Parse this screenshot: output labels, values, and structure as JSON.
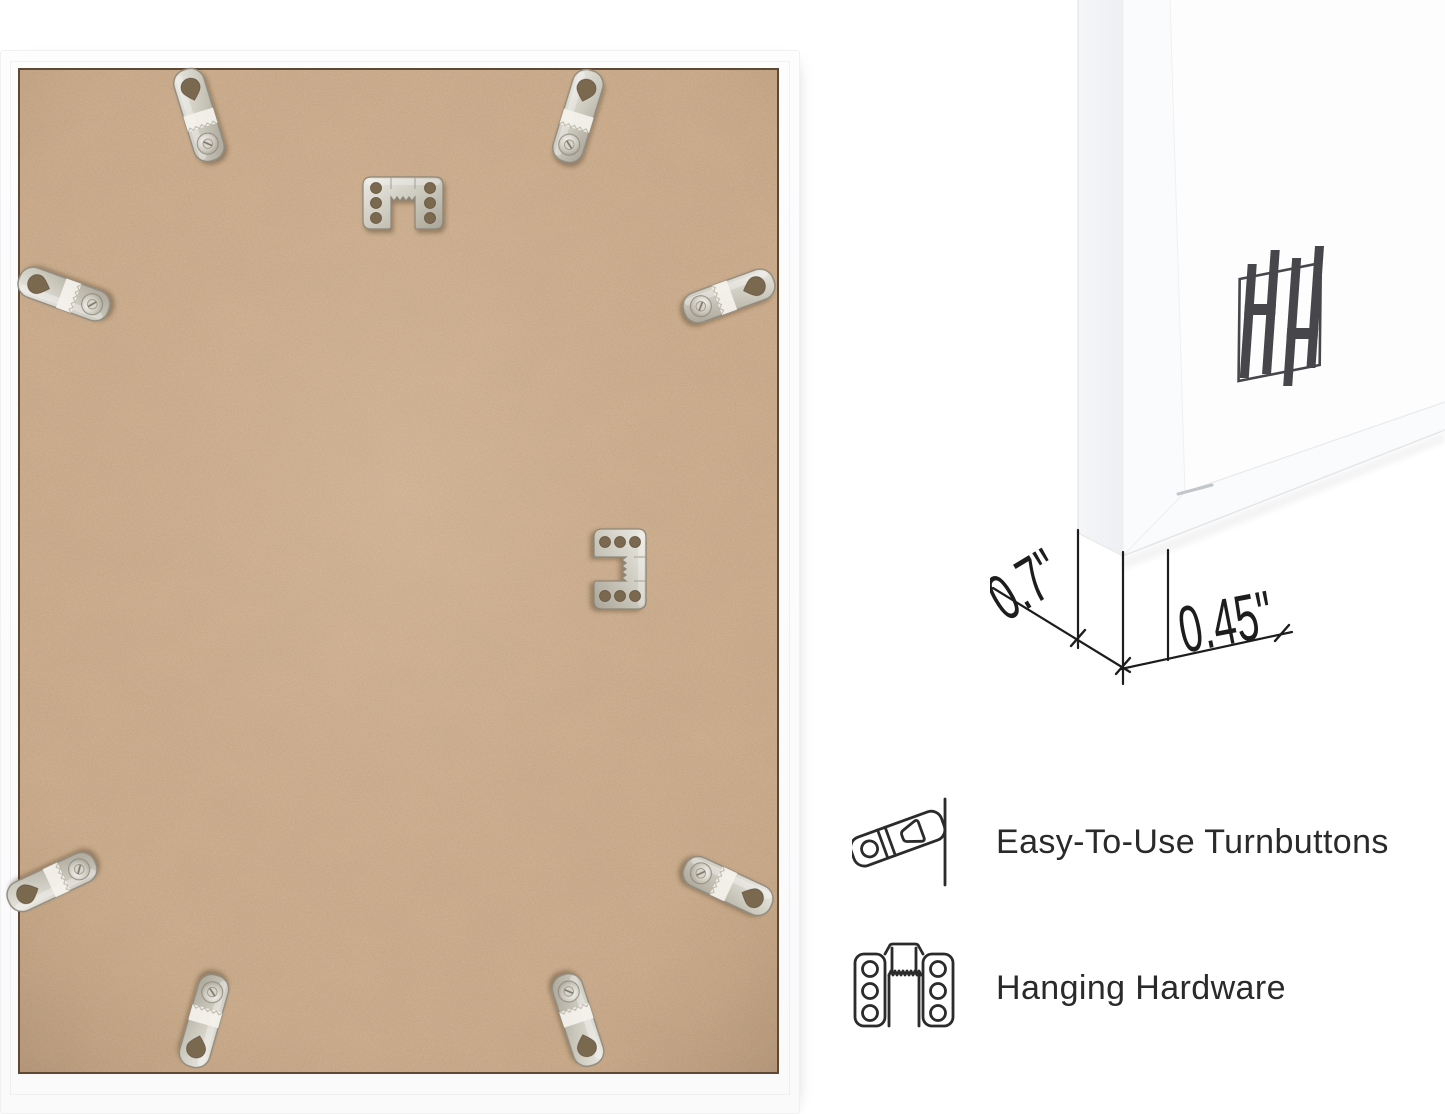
{
  "page": {
    "background_color": "#ffffff"
  },
  "frame_back_photo": {
    "frame_color": "#fbfbfc",
    "board_color": "#c6a483",
    "turnbutton_count": 8,
    "sawtooth_hanger_count": 2
  },
  "corner_mockup": {
    "logo": "hh-monogram",
    "dimensions": {
      "depth": "0.7\"",
      "width": "0.45\""
    }
  },
  "features": [
    {
      "icon": "turnbutton-icon",
      "label": "Easy-To-Use Turnbuttons"
    },
    {
      "icon": "hanging-hardware-icon",
      "label": "Hanging Hardware"
    }
  ],
  "colors": {
    "annotation": "#1d1d1d",
    "feature_text": "#2a2a2a",
    "logo": "#47474b",
    "metal": "#cdcabf",
    "board_edge": "#5d4935"
  }
}
